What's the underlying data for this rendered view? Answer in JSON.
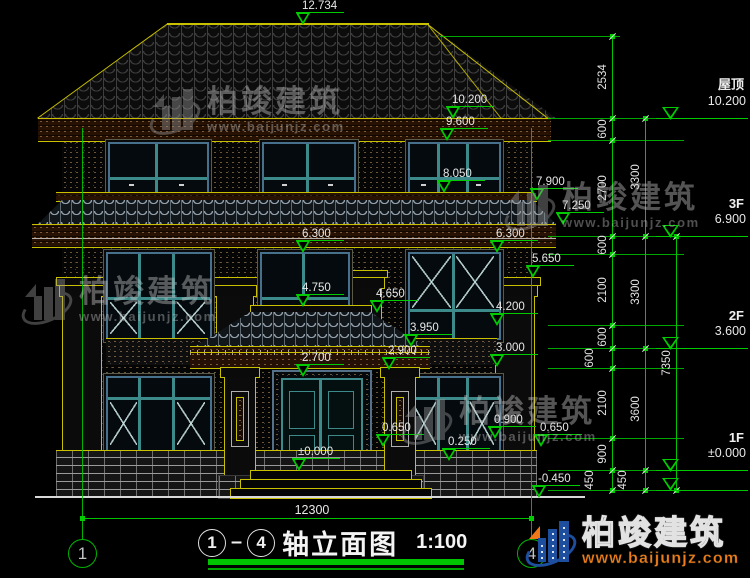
{
  "title": {
    "axis_start": "1",
    "axis_end": "4",
    "text": "轴立面图",
    "scale": "1:100"
  },
  "axes": {
    "left": "1",
    "right": "4"
  },
  "brand": {
    "name": "柏竣建筑",
    "website": "www.baijunjz.com"
  },
  "dimensions": {
    "overall_width": "12300",
    "chain_inner": [
      "2534",
      "600",
      "2700",
      "600",
      "2100",
      "600",
      "600",
      "2100",
      "900",
      "450"
    ],
    "chain_middle": [
      "3300",
      "3300",
      "3600",
      "450"
    ],
    "chain_outer": [
      "7350"
    ]
  },
  "levels": [
    {
      "name": "屋顶",
      "elevation": "10.200"
    },
    {
      "name": "3F",
      "elevation": "6.900"
    },
    {
      "name": "2F",
      "elevation": "3.600"
    },
    {
      "name": "1F",
      "elevation": "±0.000"
    }
  ],
  "elevation_markers": [
    "12.734",
    "10.200",
    "9.600",
    "8.050",
    "7.900",
    "7.250",
    "6.300",
    "6.300",
    "5.650",
    "4.750",
    "4.650",
    "4.200",
    "3.950",
    "3.000",
    "2.900",
    "2.700",
    "0.900",
    "0.650",
    "0.650",
    "0.250",
    "±0.000",
    "-0.450"
  ],
  "colors": {
    "dim_green": "#00cc00",
    "cad_yellow": "#c9c000",
    "window_teal": "#3d8a8a",
    "trim_blue": "#46708c",
    "brand_orange": "#ef7d1a",
    "brand_blue": "#1d4f9e"
  }
}
